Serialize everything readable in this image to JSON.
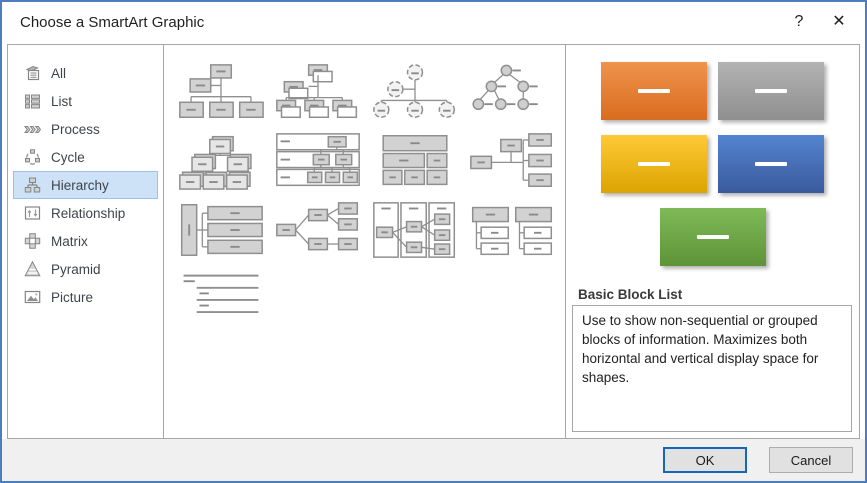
{
  "dialog": {
    "title": "Choose a SmartArt Graphic",
    "help_label": "?",
    "close_label": "✕"
  },
  "sidebar": {
    "items": [
      {
        "label": "All",
        "icon": "all-icon",
        "selected": false
      },
      {
        "label": "List",
        "icon": "list-icon",
        "selected": false
      },
      {
        "label": "Process",
        "icon": "process-icon",
        "selected": false
      },
      {
        "label": "Cycle",
        "icon": "cycle-icon",
        "selected": false
      },
      {
        "label": "Hierarchy",
        "icon": "hierarchy-icon",
        "selected": true
      },
      {
        "label": "Relationship",
        "icon": "relationship-icon",
        "selected": false
      },
      {
        "label": "Matrix",
        "icon": "matrix-icon",
        "selected": false
      },
      {
        "label": "Pyramid",
        "icon": "pyramid-icon",
        "selected": false
      },
      {
        "label": "Picture",
        "icon": "picture-icon",
        "selected": false
      }
    ]
  },
  "gallery": {
    "items": [
      {
        "name": "organization-chart"
      },
      {
        "name": "name-and-title-organization-chart"
      },
      {
        "name": "half-circle-organization-chart"
      },
      {
        "name": "circle-picture-hierarchy"
      },
      {
        "name": "picture-organization-chart"
      },
      {
        "name": "architecture-layout"
      },
      {
        "name": "table-hierarchy"
      },
      {
        "name": "horizontal-organization-chart"
      },
      {
        "name": "hierarchy-list"
      },
      {
        "name": "horizontal-hierarchy"
      },
      {
        "name": "horizontal-multi-level-hierarchy"
      },
      {
        "name": "labeled-hierarchy"
      },
      {
        "name": "lined-list"
      }
    ]
  },
  "preview": {
    "title": "Basic Block List",
    "description": "Use to show non-sequential or grouped blocks of information. Maximizes both horizontal and vertical display space for shapes.",
    "blocks": [
      {
        "name": "orange-block",
        "base": "#ED7D31",
        "from": "#F0934D",
        "to": "#D96C1E"
      },
      {
        "name": "gray-block",
        "base": "#A5A5A5",
        "from": "#B3B3B3",
        "to": "#8F8F8F"
      },
      {
        "name": "gold-block",
        "base": "#FFC000",
        "from": "#FFC937",
        "to": "#DCA400"
      },
      {
        "name": "blue-block",
        "base": "#4472C4",
        "from": "#5484D0",
        "to": "#3A5A9D"
      },
      {
        "name": "green-block",
        "base": "#70AD47",
        "from": "#7FBA57",
        "to": "#5E9338"
      }
    ]
  },
  "footer": {
    "ok_label": "OK",
    "cancel_label": "Cancel"
  },
  "colors": {
    "selection_bg": "#CDE2F6",
    "selection_border": "#9CC0E7",
    "dialog_border": "#4E7DBE"
  }
}
